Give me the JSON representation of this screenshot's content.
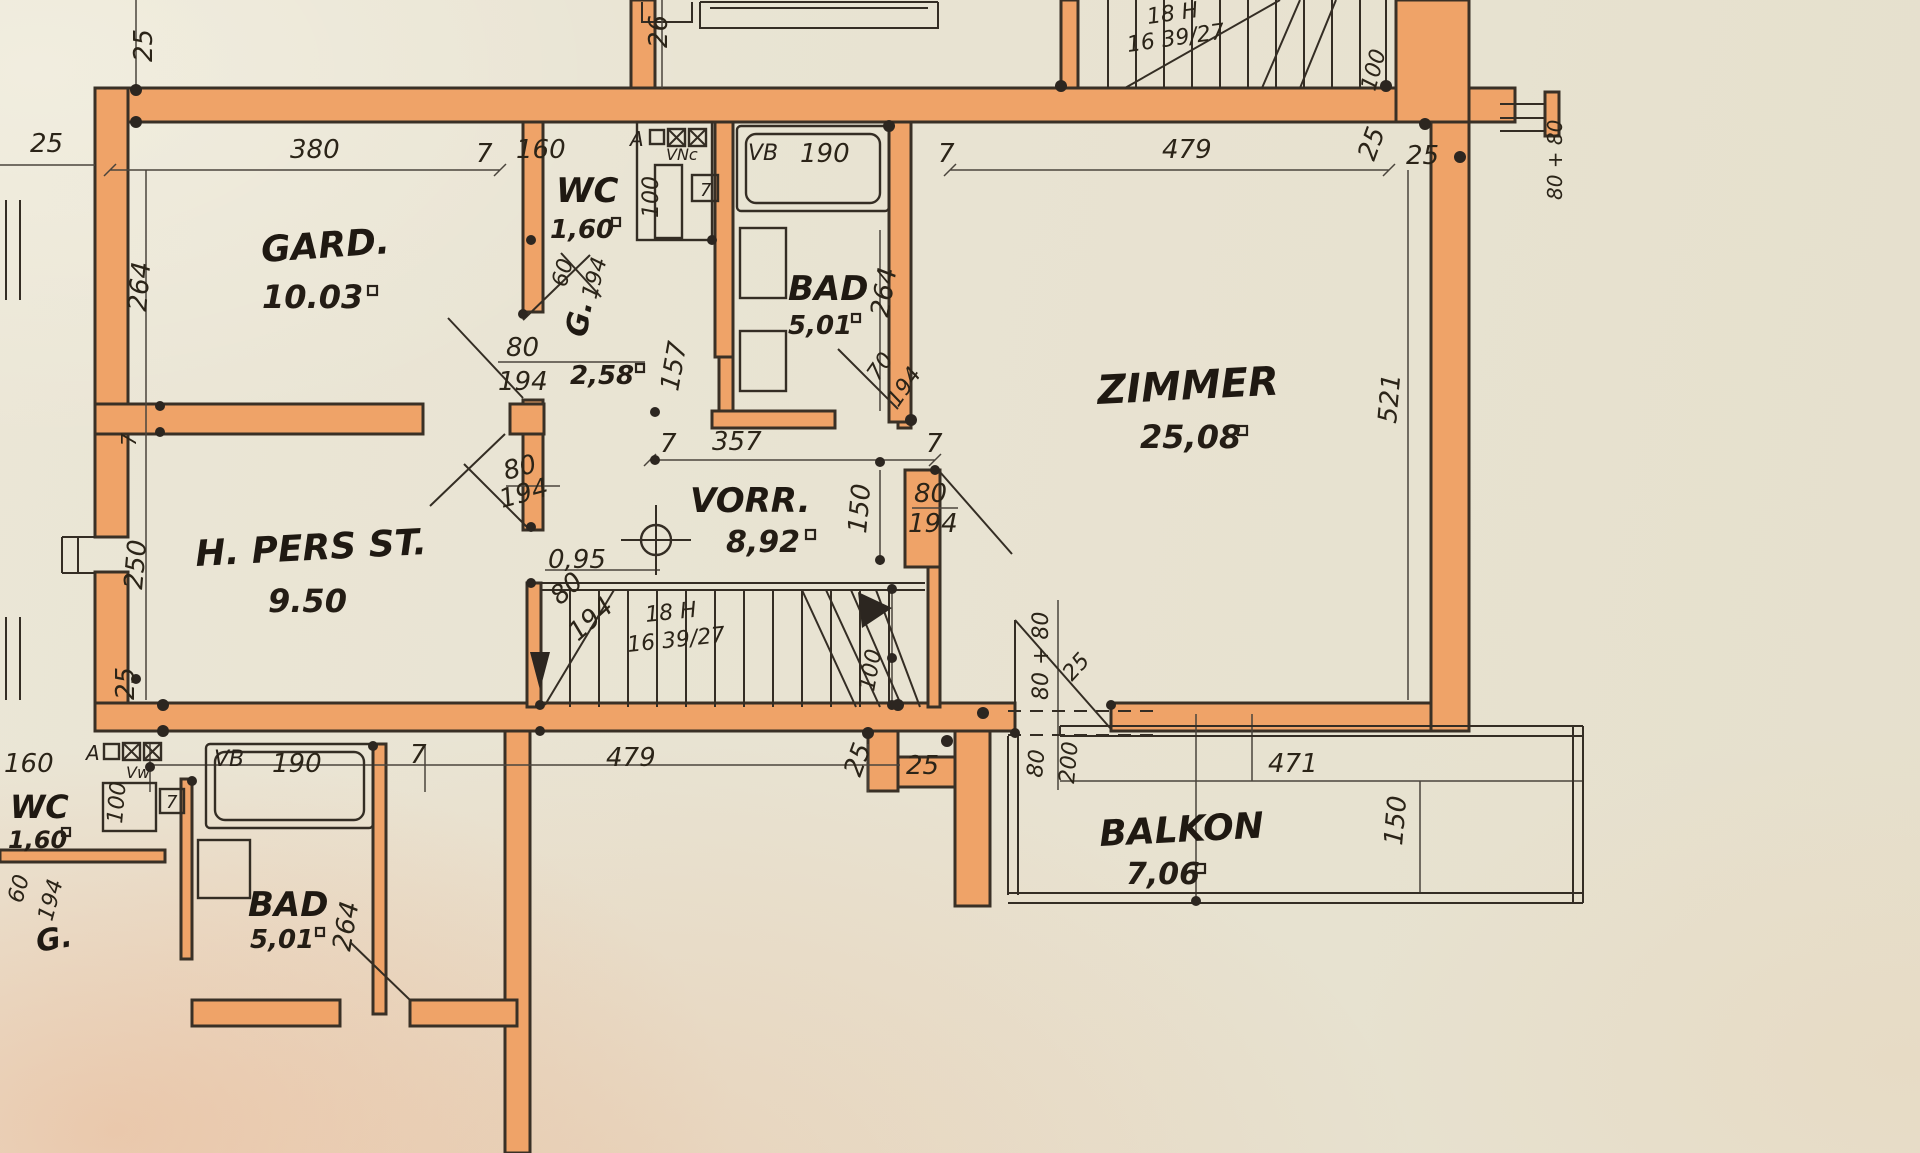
{
  "colors": {
    "paper": "#e8e3d2",
    "wall_orange": "#efa368",
    "ink": "#342d24"
  },
  "rooms": {
    "gard": {
      "name": "GARD.",
      "area": "10.03"
    },
    "wc_upper": {
      "name": "WC",
      "area": "1,60"
    },
    "g_upper": {
      "name": "G.",
      "area": "2,58"
    },
    "bad_upper": {
      "name": "BAD",
      "area": "5,01"
    },
    "zimmer": {
      "name": "ZIMMER",
      "area": "25,08"
    },
    "vorr": {
      "name": "VORR.",
      "area": "8,92"
    },
    "hpers": {
      "name": "H. PERS ST.",
      "area": "9.50"
    },
    "balkon": {
      "name": "BALKON",
      "area": "7,06"
    },
    "wc_lower": {
      "name": "WC",
      "area": "1,60"
    },
    "bad_lower": {
      "name": "BAD",
      "area": "5,01"
    },
    "g_lower": {
      "name": "G."
    }
  },
  "stairs": {
    "main_line1": "18 H",
    "main_line2": "16 39/27",
    "top_line1": "18 H",
    "top_line2": "16 39/27"
  },
  "fixtures": {
    "flue_mark": "A",
    "vent_upper": "VNc",
    "vent_lower": "Vw",
    "tub_label": "VB",
    "tub_dim": "190",
    "tub_label_lower": "VB",
    "tub_dim_lower": "190",
    "shaft_dim_upper": "100",
    "shaft_dim_lower": "100"
  },
  "dims": {
    "top_left_25": "25",
    "top_26": "26",
    "top_stairs_100": "100",
    "right_window": "80 + 80",
    "row_25": "25",
    "row_380": "380",
    "row_7a": "7",
    "row_160": "160",
    "row_7b": "7",
    "row_479": "479",
    "row_25a": "25",
    "row_25b": "25",
    "left_264": "264",
    "left_7": "7",
    "left_250": "250",
    "left_25": "25",
    "wc_7": "7",
    "wc_60": "60",
    "wc_194": "194",
    "g_157": "157",
    "g_door_80": "80",
    "g_door_194": "194",
    "bad_264": "264",
    "bad_door_70": "70",
    "bad_door_194": "194",
    "hall_357": "357",
    "hall_7a": "7",
    "hall_7b": "7",
    "hall_width": "0,95",
    "door_80": "80",
    "door_194": "194",
    "stair_door_80": "80",
    "stair_door_194": "194",
    "z_150": "150",
    "z_door_80": "80",
    "z_door_194": "194",
    "z_521": "521",
    "stair_100": "100",
    "bot_160": "160",
    "bot_7a": "7",
    "bot_479": "479",
    "bot_25a": "25",
    "bot_25b": "25",
    "bot_7b": "7",
    "bot_60": "60",
    "bot_194": "194",
    "bot_264": "264",
    "balc_80_80": "80 + 80",
    "balc_25": "25",
    "balc_80": "80",
    "balc_200": "200",
    "balc_471": "471",
    "balc_150": "150"
  }
}
